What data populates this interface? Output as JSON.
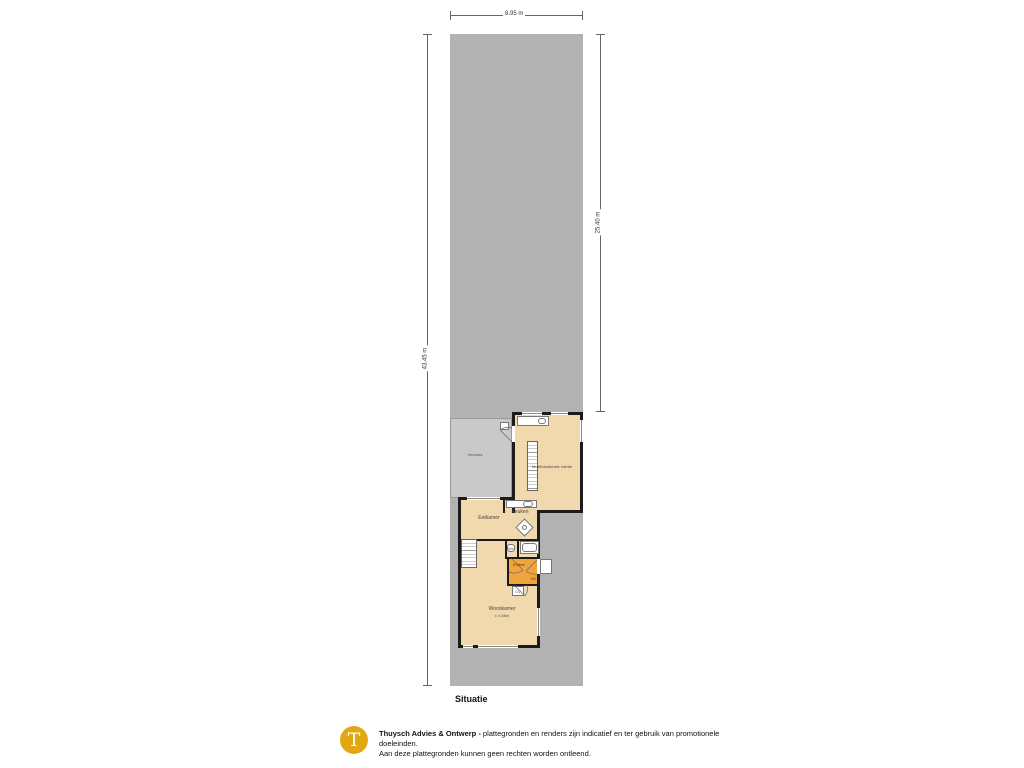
{
  "dimensions": {
    "top": "8.95 m",
    "left": "43.45 m",
    "right": "25.40 m"
  },
  "rooms": {
    "veranda": "Veranda",
    "achterhuis": "Multifunctionele ruimte",
    "eetkamer": "Eetkamer",
    "keuken": "Keuken",
    "wc": "Wc",
    "entree": "Entree",
    "mk": "MK",
    "cv": "CV",
    "woonkamer": "Woonkamer",
    "woonkamer_size": "± 4.58m"
  },
  "caption": "Situatie",
  "footer": {
    "logo_letter": "T",
    "brand": "Thuysch Advies & Ontwerp -",
    "disclaimer_1": "plattegronden en renders zijn indicatief en ter gebruik van promotionele doeleinden.",
    "disclaimer_2": "Aan deze plattegronden kunnen geen rechten worden ontleend."
  },
  "colors": {
    "plot_gray": "#b2b2b2",
    "veranda_gray": "#c9c9c9",
    "floor_tan": "#f2d9ad",
    "entree_orange": "#f1a43b",
    "wall_black": "#1b1b1b",
    "logo_gold": "#e2a713"
  }
}
